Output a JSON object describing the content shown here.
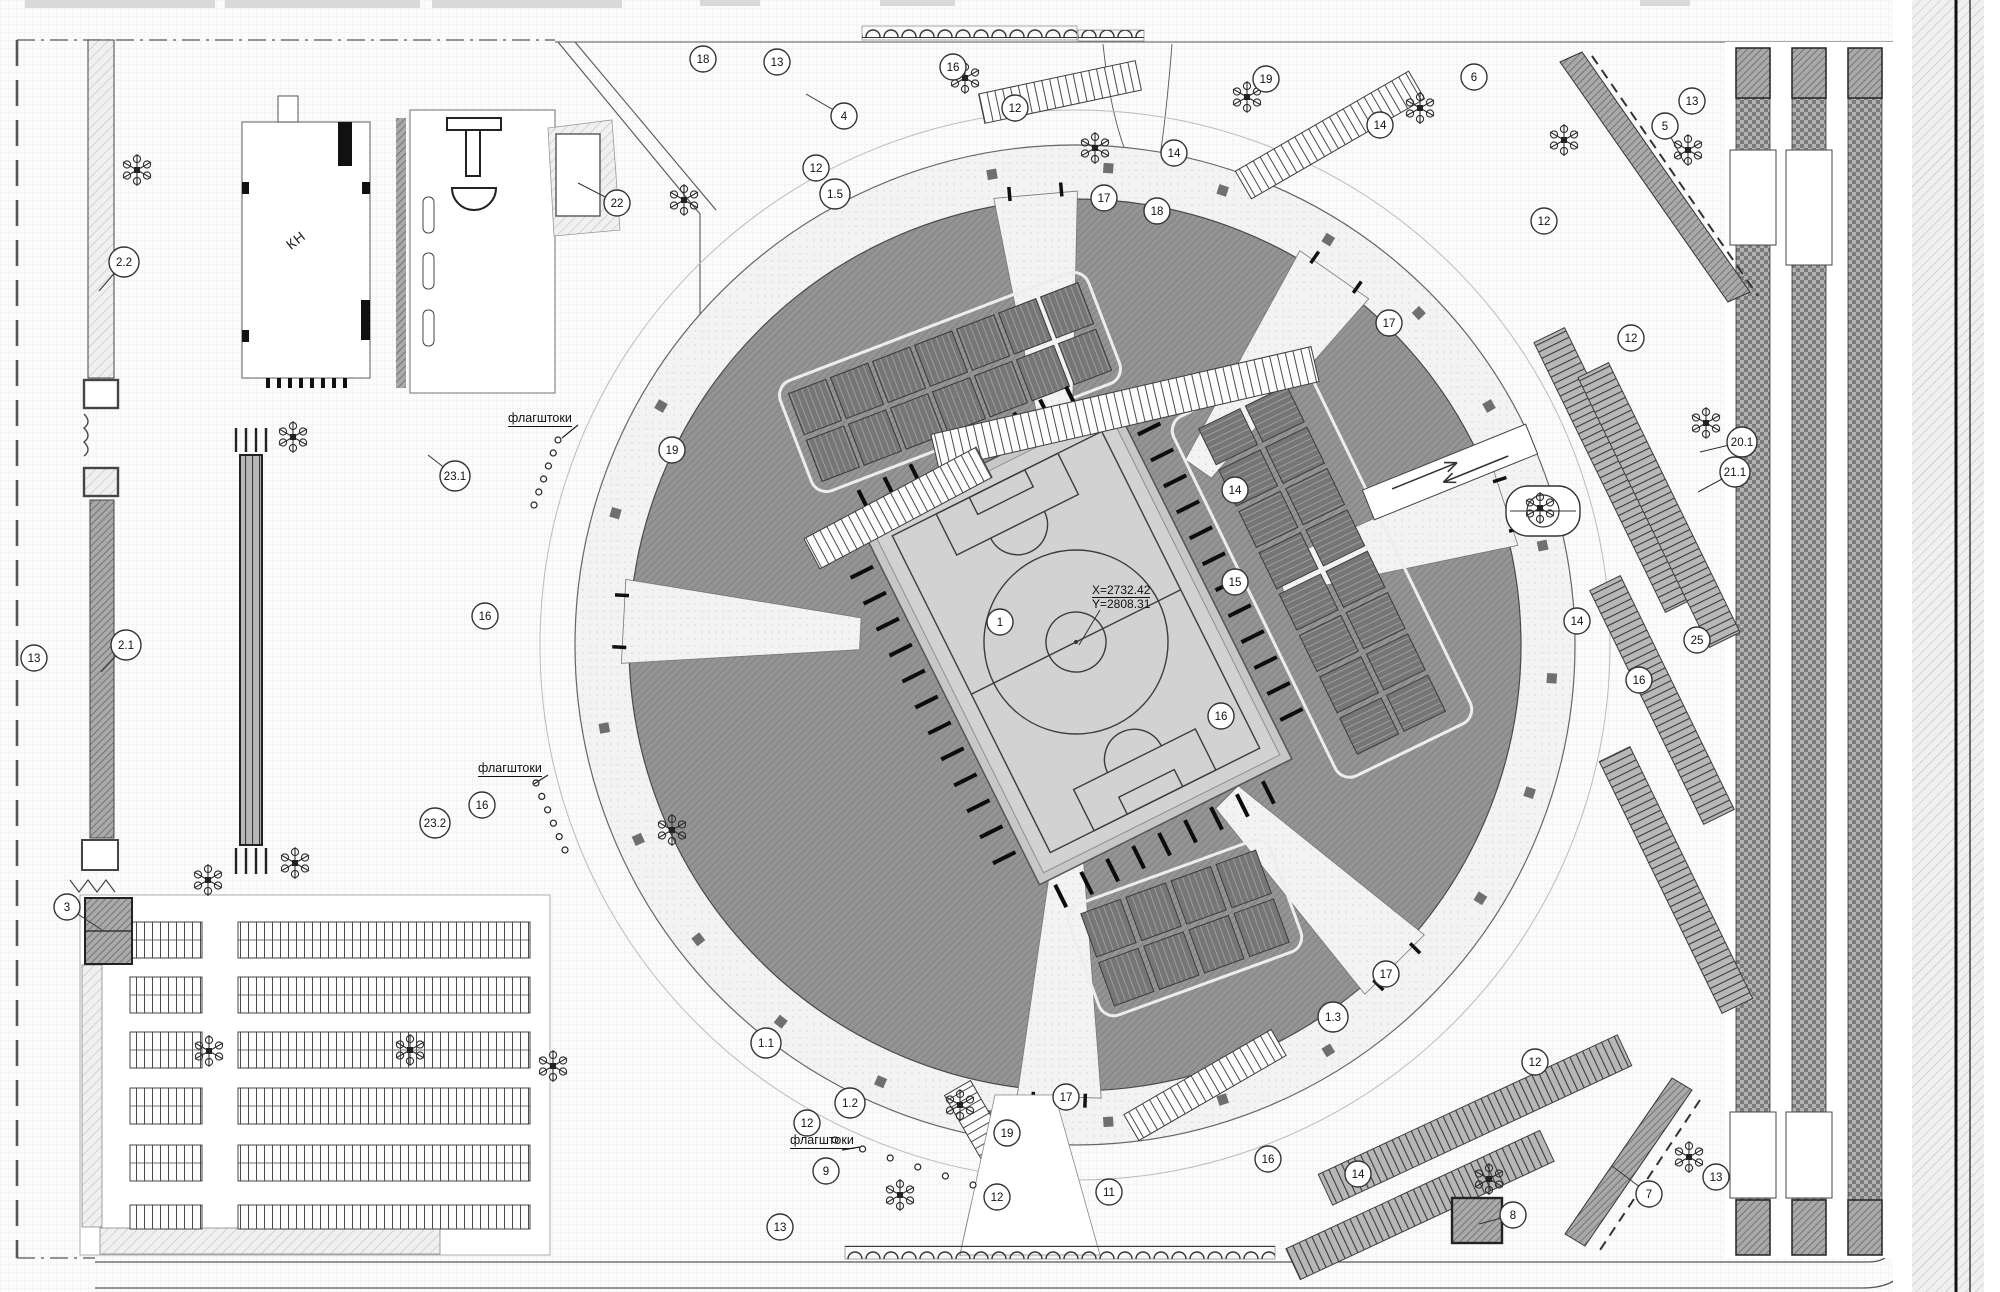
{
  "drawing": {
    "type": "site-master-plan",
    "annotations": {
      "coordinate_mark": {
        "line1": "X=2732.42",
        "line2": "Y=2808.31"
      },
      "building_label": "КН",
      "flagpole_label": "флагштоки"
    },
    "flag_labels": [
      {
        "x": 508,
        "y": 420,
        "ex": 562,
        "ey": 438
      },
      {
        "x": 478,
        "y": 770,
        "ex": 534,
        "ey": 784
      },
      {
        "x": 790,
        "y": 1142,
        "ex": 842,
        "ey": 1150
      }
    ],
    "callouts": [
      {
        "n": "1",
        "x": 1000,
        "y": 622
      },
      {
        "n": "1.1",
        "x": 766,
        "y": 1043
      },
      {
        "n": "1.2",
        "x": 850,
        "y": 1103
      },
      {
        "n": "1.3",
        "x": 1333,
        "y": 1017
      },
      {
        "n": "1.5",
        "x": 835,
        "y": 194
      },
      {
        "n": "2.1",
        "x": 126,
        "y": 645,
        "lx": 101,
        "ly": 672
      },
      {
        "n": "2.2",
        "x": 124,
        "y": 262,
        "lx": 99,
        "ly": 291
      },
      {
        "n": "3",
        "x": 67,
        "y": 907,
        "lx": 102,
        "ly": 930
      },
      {
        "n": "4",
        "x": 844,
        "y": 116,
        "lx": 806,
        "ly": 94
      },
      {
        "n": "5",
        "x": 1665,
        "y": 126,
        "lx": 1684,
        "ly": 162
      },
      {
        "n": "6",
        "x": 1474,
        "y": 77
      },
      {
        "n": "7",
        "x": 1649,
        "y": 1194,
        "lx": 1612,
        "ly": 1166
      },
      {
        "n": "8",
        "x": 1513,
        "y": 1215,
        "lx": 1479,
        "ly": 1224
      },
      {
        "n": "9",
        "x": 826,
        "y": 1171
      },
      {
        "n": "11",
        "x": 1109,
        "y": 1192
      },
      {
        "n": "12",
        "x": 1015,
        "y": 108
      },
      {
        "n": "12",
        "x": 816,
        "y": 168
      },
      {
        "n": "12",
        "x": 1544,
        "y": 221
      },
      {
        "n": "12",
        "x": 1631,
        "y": 338
      },
      {
        "n": "12",
        "x": 807,
        "y": 1123
      },
      {
        "n": "12",
        "x": 997,
        "y": 1197
      },
      {
        "n": "12",
        "x": 1535,
        "y": 1062
      },
      {
        "n": "13",
        "x": 777,
        "y": 62
      },
      {
        "n": "13",
        "x": 34,
        "y": 658
      },
      {
        "n": "13",
        "x": 1692,
        "y": 101
      },
      {
        "n": "13",
        "x": 780,
        "y": 1227
      },
      {
        "n": "13",
        "x": 1716,
        "y": 1177
      },
      {
        "n": "14",
        "x": 1174,
        "y": 153
      },
      {
        "n": "14",
        "x": 1380,
        "y": 125
      },
      {
        "n": "14",
        "x": 1235,
        "y": 490
      },
      {
        "n": "14",
        "x": 1577,
        "y": 621
      },
      {
        "n": "14",
        "x": 1358,
        "y": 1174
      },
      {
        "n": "15",
        "x": 1235,
        "y": 582
      },
      {
        "n": "16",
        "x": 953,
        "y": 67
      },
      {
        "n": "16",
        "x": 485,
        "y": 616
      },
      {
        "n": "16",
        "x": 482,
        "y": 805
      },
      {
        "n": "16",
        "x": 1221,
        "y": 716
      },
      {
        "n": "16",
        "x": 1639,
        "y": 680
      },
      {
        "n": "16",
        "x": 1268,
        "y": 1159
      },
      {
        "n": "17",
        "x": 1104,
        "y": 198
      },
      {
        "n": "17",
        "x": 1389,
        "y": 323
      },
      {
        "n": "17",
        "x": 1386,
        "y": 974
      },
      {
        "n": "17",
        "x": 1066,
        "y": 1097
      },
      {
        "n": "18",
        "x": 703,
        "y": 59
      },
      {
        "n": "18",
        "x": 1157,
        "y": 211
      },
      {
        "n": "19",
        "x": 672,
        "y": 450
      },
      {
        "n": "19",
        "x": 1266,
        "y": 79
      },
      {
        "n": "19",
        "x": 1007,
        "y": 1133
      },
      {
        "n": "20.1",
        "x": 1742,
        "y": 442,
        "lx": 1700,
        "ly": 452
      },
      {
        "n": "21.1",
        "x": 1735,
        "y": 472,
        "lx": 1698,
        "ly": 492
      },
      {
        "n": "22",
        "x": 617,
        "y": 203,
        "lx": 578,
        "ly": 183
      },
      {
        "n": "23.1",
        "x": 455,
        "y": 476,
        "lx": 428,
        "ly": 455
      },
      {
        "n": "23.2",
        "x": 435,
        "y": 823
      },
      {
        "n": "25",
        "x": 1697,
        "y": 640
      }
    ],
    "trees": [
      {
        "x": 137,
        "y": 170
      },
      {
        "x": 293,
        "y": 437
      },
      {
        "x": 295,
        "y": 863
      },
      {
        "x": 684,
        "y": 200
      },
      {
        "x": 965,
        "y": 78
      },
      {
        "x": 1095,
        "y": 148
      },
      {
        "x": 1247,
        "y": 97
      },
      {
        "x": 1420,
        "y": 108
      },
      {
        "x": 1564,
        "y": 140
      },
      {
        "x": 1688,
        "y": 150
      },
      {
        "x": 1706,
        "y": 423
      },
      {
        "x": 1540,
        "y": 508
      },
      {
        "x": 209,
        "y": 1051
      },
      {
        "x": 410,
        "y": 1050
      },
      {
        "x": 553,
        "y": 1066
      },
      {
        "x": 900,
        "y": 1195
      },
      {
        "x": 1489,
        "y": 1179
      },
      {
        "x": 1689,
        "y": 1157
      },
      {
        "x": 208,
        "y": 880
      },
      {
        "x": 672,
        "y": 830
      },
      {
        "x": 960,
        "y": 1105
      }
    ],
    "colors": {
      "lawn_sector": "#8f8f8f",
      "pitch_fill": "#d2d2d2",
      "pitch_lines": "#3c3c3c",
      "court_fill": "#767676",
      "plaza": "#f3f3f3",
      "hatch_dark": "#a9a9a9",
      "ink": "#111111"
    }
  }
}
